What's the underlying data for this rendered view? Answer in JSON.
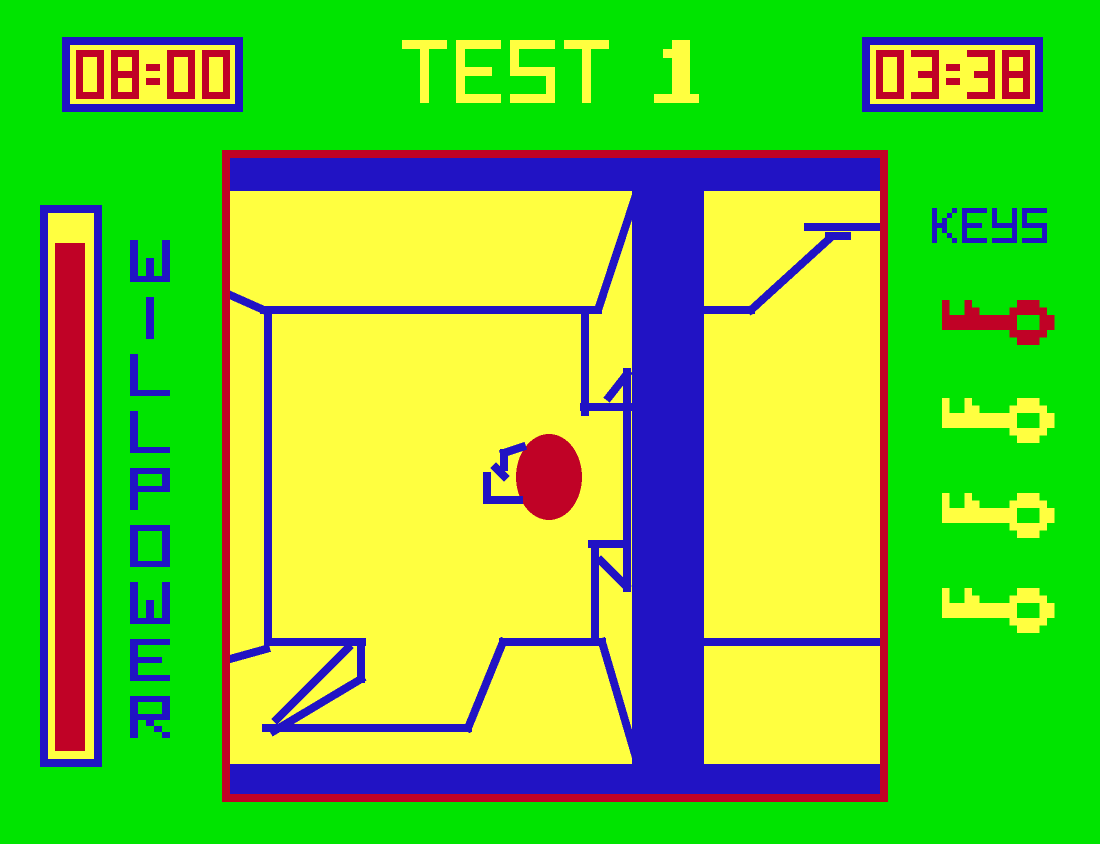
{
  "title": "TEST 1",
  "clocks": {
    "left": "08:00",
    "right": "03:38"
  },
  "meter": {
    "label": "WILLPOWER",
    "fill_percent": 93
  },
  "keys": {
    "label": "KEYS",
    "collected_colors": [
      "red",
      "yellow",
      "yellow",
      "yellow"
    ]
  },
  "palette": {
    "green": "#00E400",
    "yellow": "#FFFF40",
    "blue": "#2113C4",
    "red": "#C00226"
  },
  "game_view": {
    "border_color": "red",
    "wall_color": "blue",
    "floor_color": "yellow",
    "blue_blocks": [
      [
        8,
        8,
        650,
        33
      ],
      [
        8,
        614,
        650,
        30
      ],
      [
        410,
        8,
        72,
        636
      ]
    ],
    "segments": [
      [
        8,
        145,
        44,
        161
      ],
      [
        42,
        160,
        376,
        160
      ],
      [
        46,
        162,
        46,
        492
      ],
      [
        46,
        492,
        140,
        492
      ],
      [
        139,
        492,
        139,
        529
      ],
      [
        139,
        529,
        52,
        581
      ],
      [
        126,
        498,
        55,
        569
      ],
      [
        44,
        578,
        246,
        578
      ],
      [
        8,
        509,
        44,
        499
      ],
      [
        246,
        578,
        281,
        492
      ],
      [
        281,
        492,
        380,
        492
      ],
      [
        380,
        492,
        415,
        611
      ],
      [
        377,
        157,
        413,
        48
      ],
      [
        363,
        168,
        363,
        262
      ],
      [
        362,
        257,
        409,
        257
      ],
      [
        405,
        222,
        405,
        438
      ],
      [
        405,
        224,
        387,
        247
      ],
      [
        370,
        394,
        403,
        394
      ],
      [
        373,
        395,
        373,
        490
      ],
      [
        379,
        411,
        404,
        436
      ],
      [
        481,
        160,
        529,
        160
      ],
      [
        529,
        160,
        607,
        89
      ],
      [
        607,
        86,
        625,
        86
      ],
      [
        586,
        77,
        657,
        77
      ],
      [
        481,
        492,
        657,
        492
      ]
    ],
    "player": {
      "cx": 327,
      "cy": 327,
      "rx": 33,
      "ry": 43,
      "color": "red",
      "appendage": [
        [
          300,
          297,
          282,
          303
        ],
        [
          282,
          303,
          282,
          317
        ],
        [
          274,
          318,
          282,
          326
        ],
        [
          265,
          326,
          265,
          350
        ],
        [
          265,
          350,
          297,
          350
        ]
      ]
    }
  }
}
